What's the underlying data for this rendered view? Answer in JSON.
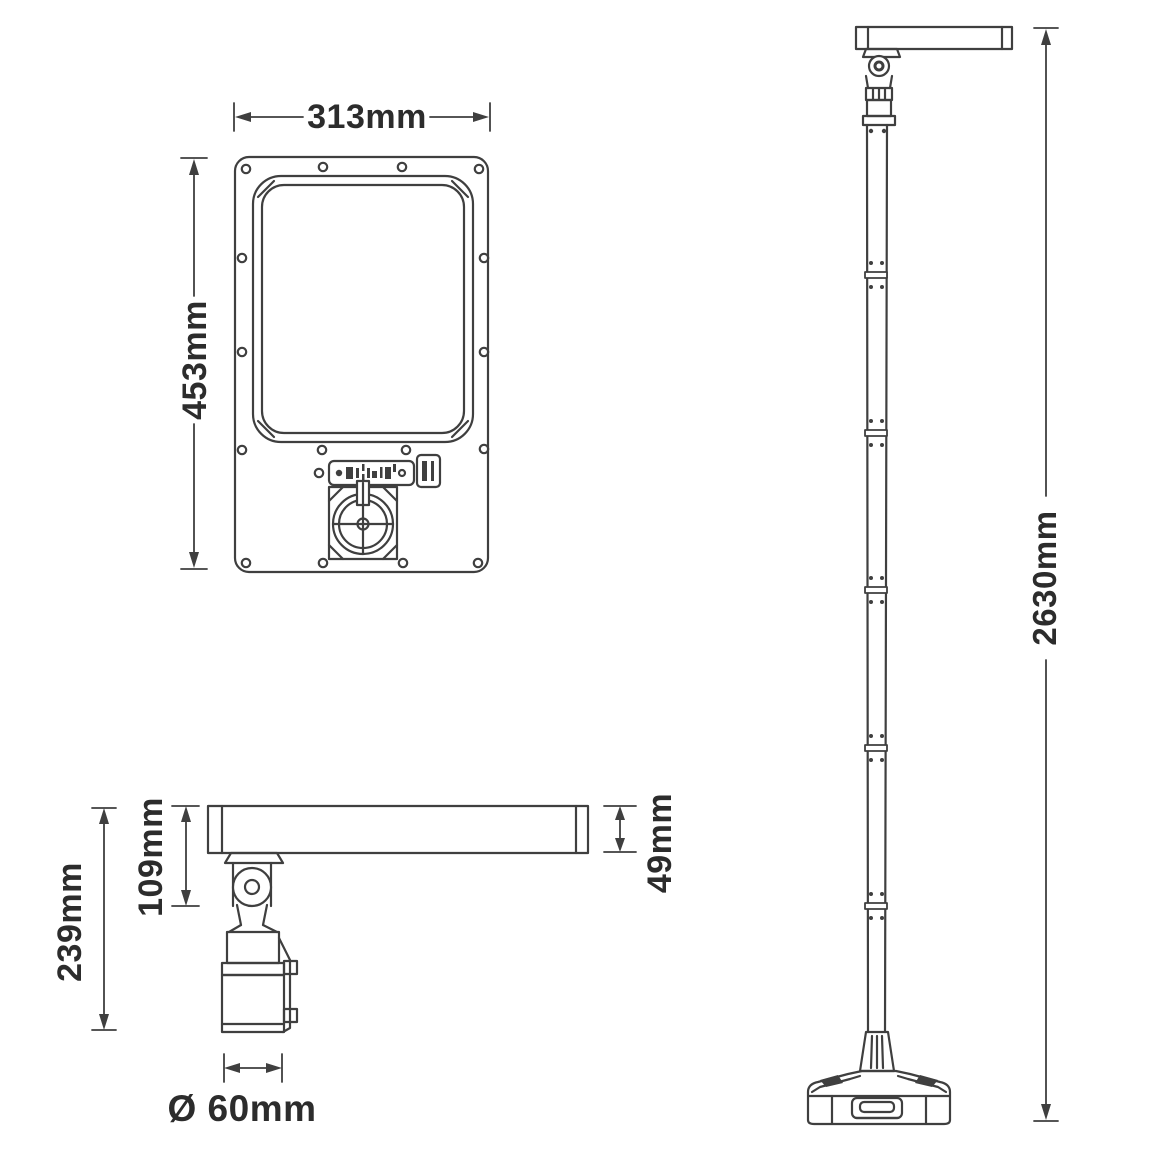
{
  "dimension_labels": {
    "front_width": "313mm",
    "front_height": "453mm",
    "side_overall_height": "239mm",
    "side_pivot_height": "109mm",
    "head_thickness": "49mm",
    "mount_diameter": "Ø 60mm",
    "pole_overall_height": "2630mm"
  },
  "colors": {
    "line": "#3f3f3f",
    "text": "#2c2c2c",
    "background": "#ffffff"
  }
}
